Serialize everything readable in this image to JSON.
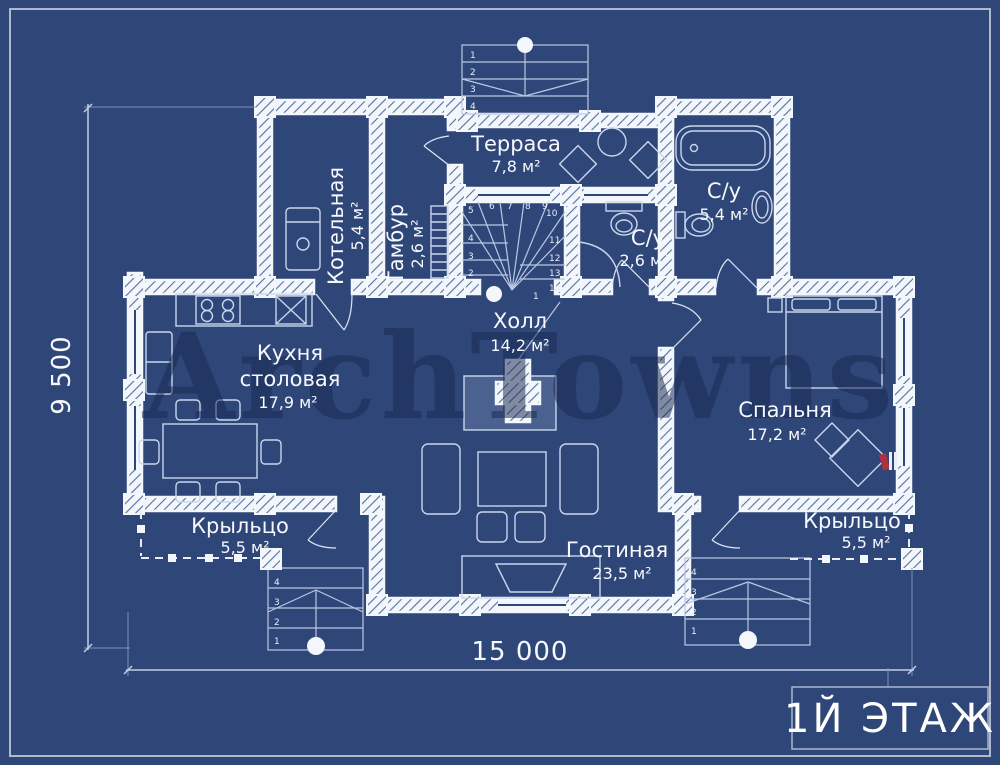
{
  "watermark": "ArchTowns",
  "title_block": {
    "floor_label": "1Й ЭТАЖ"
  },
  "dimensions": {
    "horizontal": "15 000",
    "vertical": "9 500"
  },
  "colors": {
    "background": "#2f4679",
    "wall_white": "#f3f6fb",
    "hatch_line": "#54719f",
    "furniture_line": "#c9d6ec",
    "text": "#f6f8fc",
    "watermark": "#182a52",
    "accent_red": "#b03040"
  },
  "rooms": {
    "terrace": {
      "name": "Терраса",
      "area": "7,8 м²"
    },
    "boiler": {
      "name": "Котельная",
      "area": "5,4 м²"
    },
    "tambour": {
      "name": "Тамбур",
      "area": "2,6 м²"
    },
    "bathroom_large": {
      "name": "С/у",
      "area": "5,4 м²"
    },
    "bathroom_small": {
      "name": "С/у",
      "area": "2,6 м²"
    },
    "hall": {
      "name": "Холл",
      "area": "14,2 м²"
    },
    "kitchen": {
      "name": "Кухня",
      "name2": "столовая",
      "area": "17,9 м²"
    },
    "bedroom": {
      "name": "Спальня",
      "area": "17,2 м²"
    },
    "living": {
      "name": "Гостиная",
      "area": "23,5 м²"
    },
    "porch_left": {
      "name": "Крыльцо",
      "area": "5,5 м²"
    },
    "porch_right": {
      "name": "Крыльцо",
      "area": "5,5 м²"
    }
  },
  "stairs": {
    "entry": [
      "1",
      "2",
      "3",
      "4"
    ],
    "main": [
      "1",
      "2",
      "3",
      "4",
      "5",
      "6",
      "7",
      "8",
      "9",
      "10",
      "11",
      "12",
      "13",
      "14"
    ],
    "porch_left": [
      "1",
      "2",
      "3",
      "4"
    ],
    "porch_right": [
      "1",
      "2",
      "3",
      "4"
    ]
  }
}
